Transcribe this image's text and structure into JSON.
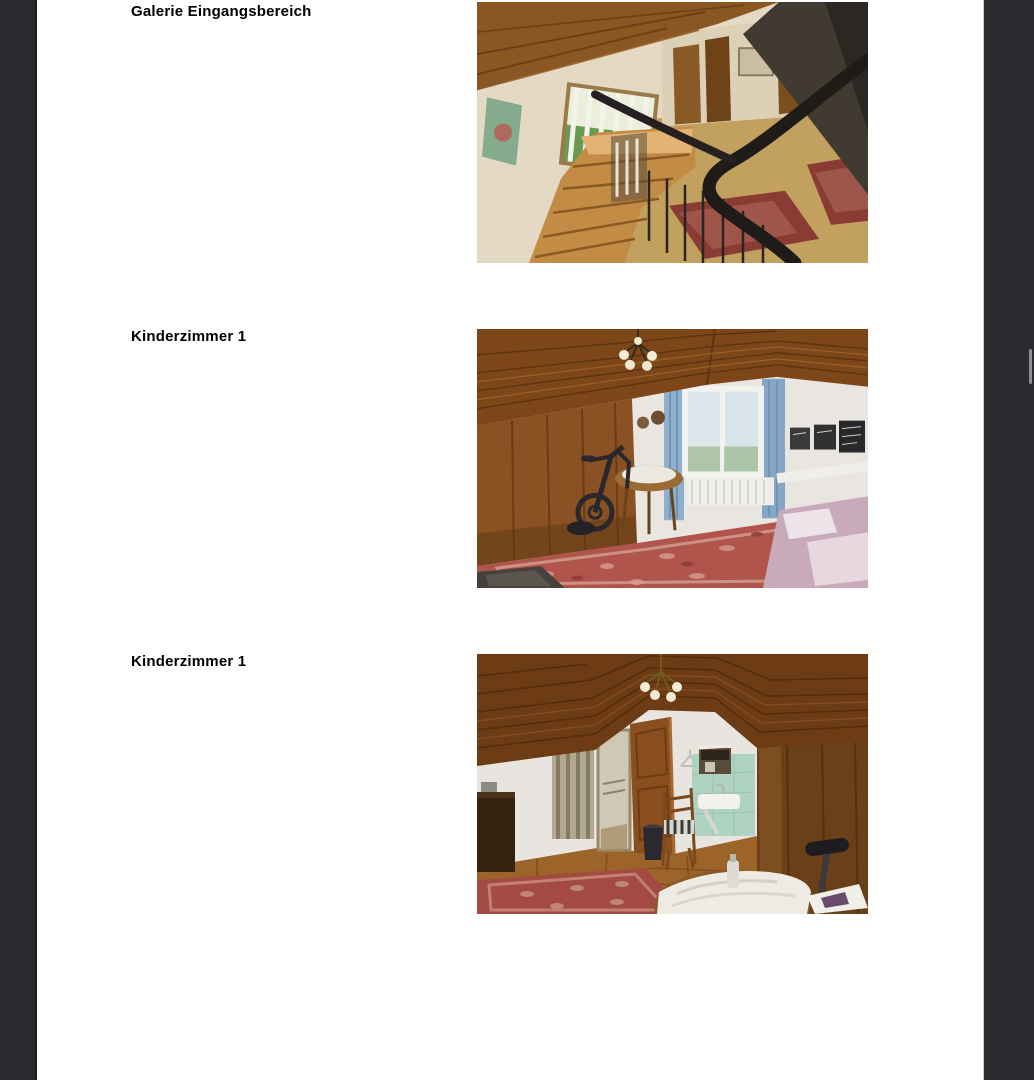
{
  "viewer": {
    "background_color": "#2a2a2e",
    "page_background": "#ffffff",
    "scrollbar_thumb_color": "#8e8e92"
  },
  "document": {
    "rows": [
      {
        "caption": "Galerie Eingangsbereich",
        "photo": "gallery-view-over-staircase-entrance-area"
      },
      {
        "caption": "Kinderzimmer 1",
        "photo": "attic-childrens-room-with-window-exercise-bike-round-table"
      },
      {
        "caption": "Kinderzimmer 1",
        "photo": "attic-childrens-room-with-open-door-sink-chair"
      }
    ]
  }
}
